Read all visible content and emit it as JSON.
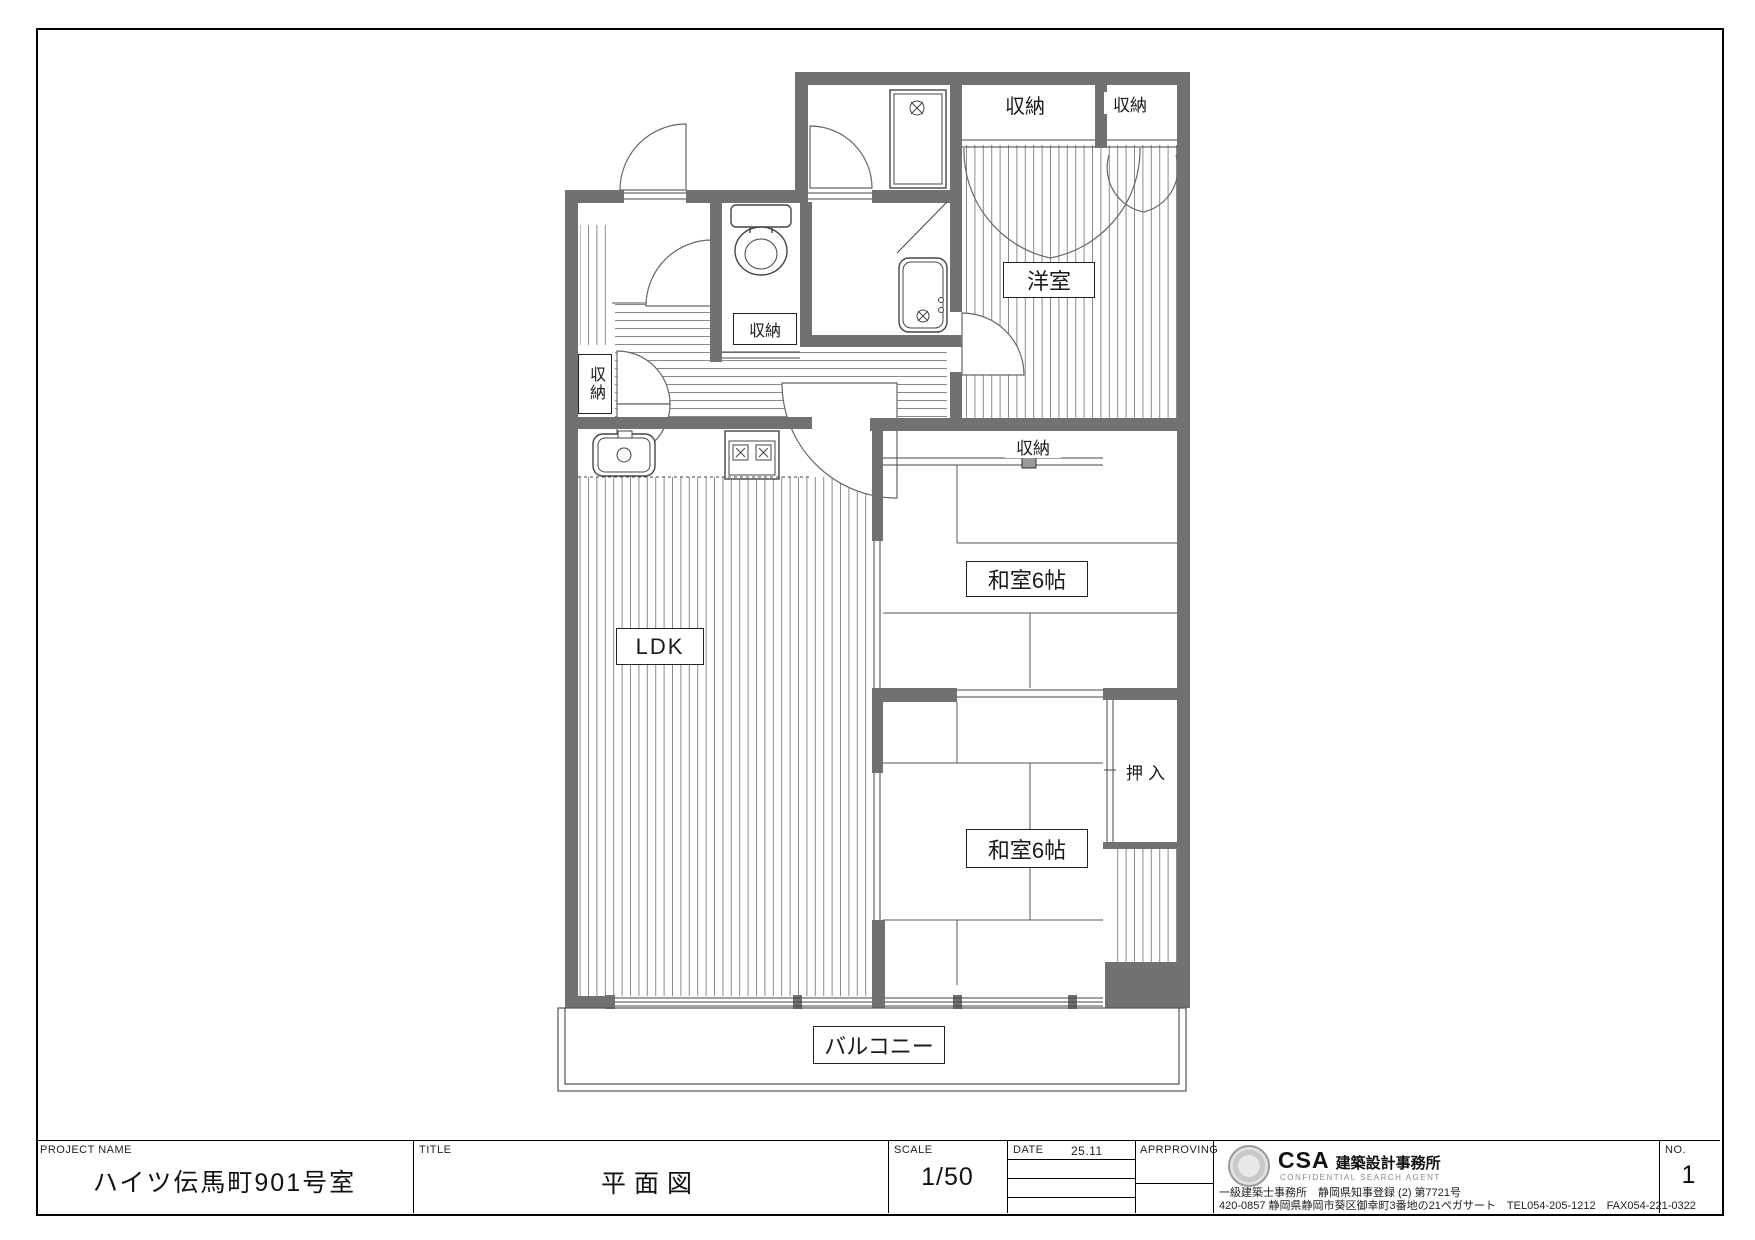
{
  "plan": {
    "room_labels": {
      "ldk": "LDK",
      "western_room": "洋室",
      "japanese_room_1": "和室6帖",
      "japanese_room_2": "和室6帖",
      "oshiire": "押入",
      "balcony": "バルコニー",
      "closet_top_1": "収納",
      "closet_top_2": "収納",
      "closet_hall": "収納",
      "closet_entrance": "収納",
      "closet_japanese_room": "収納"
    }
  },
  "titleblock": {
    "project_name_label": "PROJECT NAME",
    "project_name": "ハイツ伝馬町901号室",
    "title_label": "TITLE",
    "title": "平面図",
    "scale_label": "SCALE",
    "scale": "1/50",
    "date_label": "DATE",
    "date": "25.11",
    "approving_label": "APRPROVING",
    "no_label": "NO.",
    "sheet_number": "1",
    "company": {
      "logo_text": "CSA",
      "logo_name": "建築設計事務所",
      "logo_subtitle": "CONFIDENTIAL SEARCH AGENT",
      "registration": "一級建築士事務所　静岡県知事登録 (2) 第7721号",
      "address": "420-0857 静岡県静岡市葵区御幸町3番地の21ペガサート　TEL054-205-1212　FAX054-221-0322"
    }
  }
}
